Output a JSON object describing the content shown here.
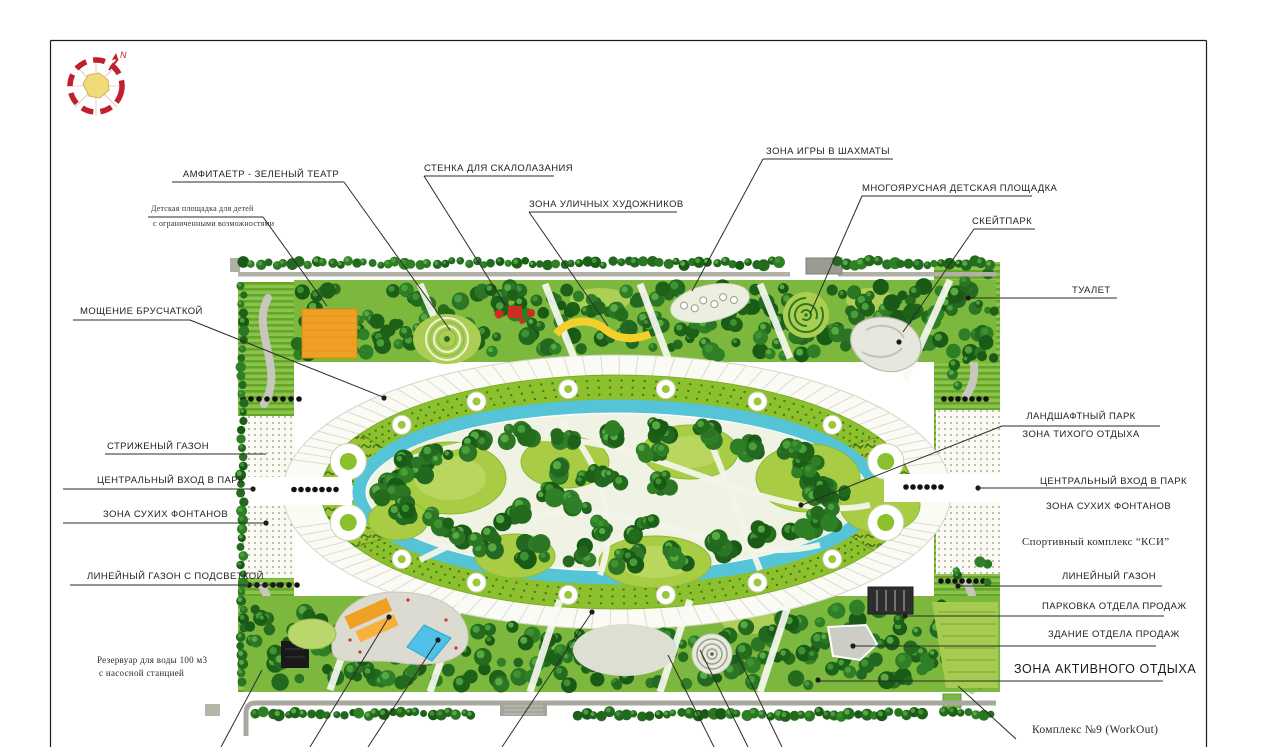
{
  "compass": {
    "north_label": "N"
  },
  "annotations": {
    "amphitheater": "АМФИТАЕТР - ЗЕЛЕНЫЙ ТЕАТР",
    "disabled_playground_line1": "Детская площадка для детей",
    "disabled_playground_line2": "с ограниченными возможностями",
    "climbing_wall": "СТЕНКА ДЛЯ СКАЛОЛАЗАНИЯ",
    "street_artists": "ЗОНА УЛИЧНЫХ ХУДОЖНИКОВ",
    "chess": "ЗОНА ИГРЫ В ШАХМАТЫ",
    "multilevel_playground": "МНОГОЯРУСНАЯ ДЕТСКАЯ ПЛОЩАДКА",
    "skatepark": "СКЕЙТПАРК",
    "toilet": "ТУАЛЕТ",
    "paving": "МОЩЕНИЕ БРУСЧАТКОЙ",
    "trimmed_lawn": "СТРИЖЕНЫЙ ГАЗОН",
    "central_entrance_left": "ЦЕНТРАЛЬНЫЙ ВХОД В ПАРК",
    "dry_fountains_left": "ЗОНА СУХИХ ФОНТАНОВ",
    "linear_lawn_lit": "ЛИНЕЙНЫЙ ГАЗОН С ПОДСВЕТКОЙ",
    "reservoir_line1": "Резервуар для воды 100 м3",
    "reservoir_line2": "с насосной станцией",
    "landscape_park_line1": "ЛАНДШАФТНЫЙ ПАРК",
    "landscape_park_line2": "ЗОНА ТИХОГО ОТДЫХА",
    "central_entrance_right": "ЦЕНТРАЛЬНЫЙ ВХОД В ПАРК",
    "dry_fountains_right": "ЗОНА СУХИХ ФОНТАНОВ",
    "sport_complex": "Спортивный комплекс “КСИ”",
    "linear_lawn_right": "ЛИНЕЙНЫЙ ГАЗОН",
    "parking": "ПАРКОВКА ОТДЕЛА ПРОДАЖ",
    "sales_building": "ЗДАНИЕ ОТДЕЛА ПРОДАЖ",
    "active_recreation": "ЗОНА АКТИВНОГО ОТДЫХА",
    "workout": "Комплекс №9 (WorkOut)"
  },
  "palette": {
    "leader_line": "#2b2b2b",
    "tree_dark": "#1d6119",
    "water": "#54c4d6",
    "hedge": "#8cc02c",
    "lawn_light": "#a6cc3f",
    "promenade": "#fbfbf5",
    "orange_feature": "#f0a125",
    "red_feature": "#cc2e20",
    "yellow_feature": "#f3d02c",
    "blue_feature": "#4fc0e8",
    "compass_red": "#c0202e",
    "compass_yellow": "#f1da78"
  }
}
